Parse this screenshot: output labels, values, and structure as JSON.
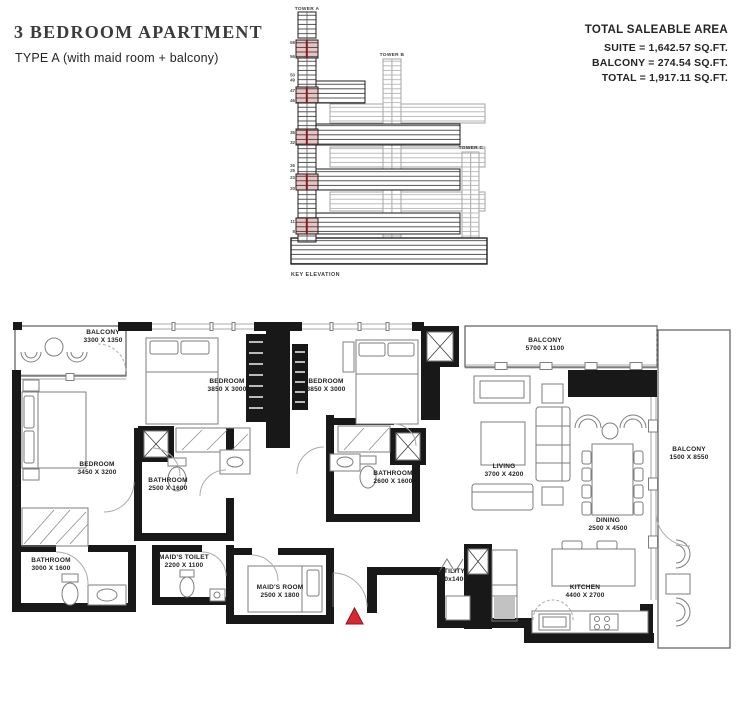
{
  "header": {
    "title": "3 BEDROOM APARTMENT",
    "subtitle": "TYPE A (with maid room + balcony)"
  },
  "area_summary": {
    "heading": "TOTAL SALEABLE AREA",
    "suite": "SUITE = 1,642.57 SQ.FT.",
    "balcony": "BALCONY = 274.54 SQ.FT.",
    "total": "TOTAL = 1,917.11 SQ.FT."
  },
  "key_elevation": {
    "caption": "KEY ELEVATION",
    "tower_a": "TOWER A",
    "tower_b": "TOWER B",
    "tower_c": "TOWER C",
    "floors": [
      "58",
      "56",
      "50",
      "49",
      "47",
      "46",
      "35",
      "32",
      "26",
      "25",
      "23",
      "20",
      "11",
      "8"
    ],
    "highlight_color": "#ecc3c3",
    "highlight_line_color": "#7c2022"
  },
  "floor_plan": {
    "entry_marker_color": "#d7282f",
    "rooms": {
      "balcony_tl": {
        "name": "BALCONY",
        "dims": "3300 X 1350"
      },
      "bedroom_mid": {
        "name": "BEDROOM",
        "dims": "3850 X 3000"
      },
      "bedroom_right": {
        "name": "BEDROOM",
        "dims": "3850 X 3000"
      },
      "bedroom_left": {
        "name": "BEDROOM",
        "dims": "3450 X 3200"
      },
      "bathroom_1": {
        "name": "BATHROOM",
        "dims": "2500 X 1600"
      },
      "bathroom_2": {
        "name": "BATHROOM",
        "dims": "2600 X 1600"
      },
      "balcony_top": {
        "name": "BALCONY",
        "dims": "5700 X 1100"
      },
      "living": {
        "name": "LIVING",
        "dims": "3700 X 4200"
      },
      "balcony_right": {
        "name": "BALCONY",
        "dims": "1500 X 8550"
      },
      "dining": {
        "name": "DINING",
        "dims": "2500 X 4500"
      },
      "bathroom_3": {
        "name": "BATHROOM",
        "dims": "3000 X 1600"
      },
      "maids_toilet": {
        "name": "MAID'S TOILET",
        "dims": "2200 X 1100"
      },
      "maids_room": {
        "name": "MAID'S ROOM",
        "dims": "2500 X 1800"
      },
      "utility": {
        "name": "UTILITY",
        "dims": "900x1400"
      },
      "kitchen": {
        "name": "KITCHEN",
        "dims": "4400 X 2700"
      }
    }
  }
}
